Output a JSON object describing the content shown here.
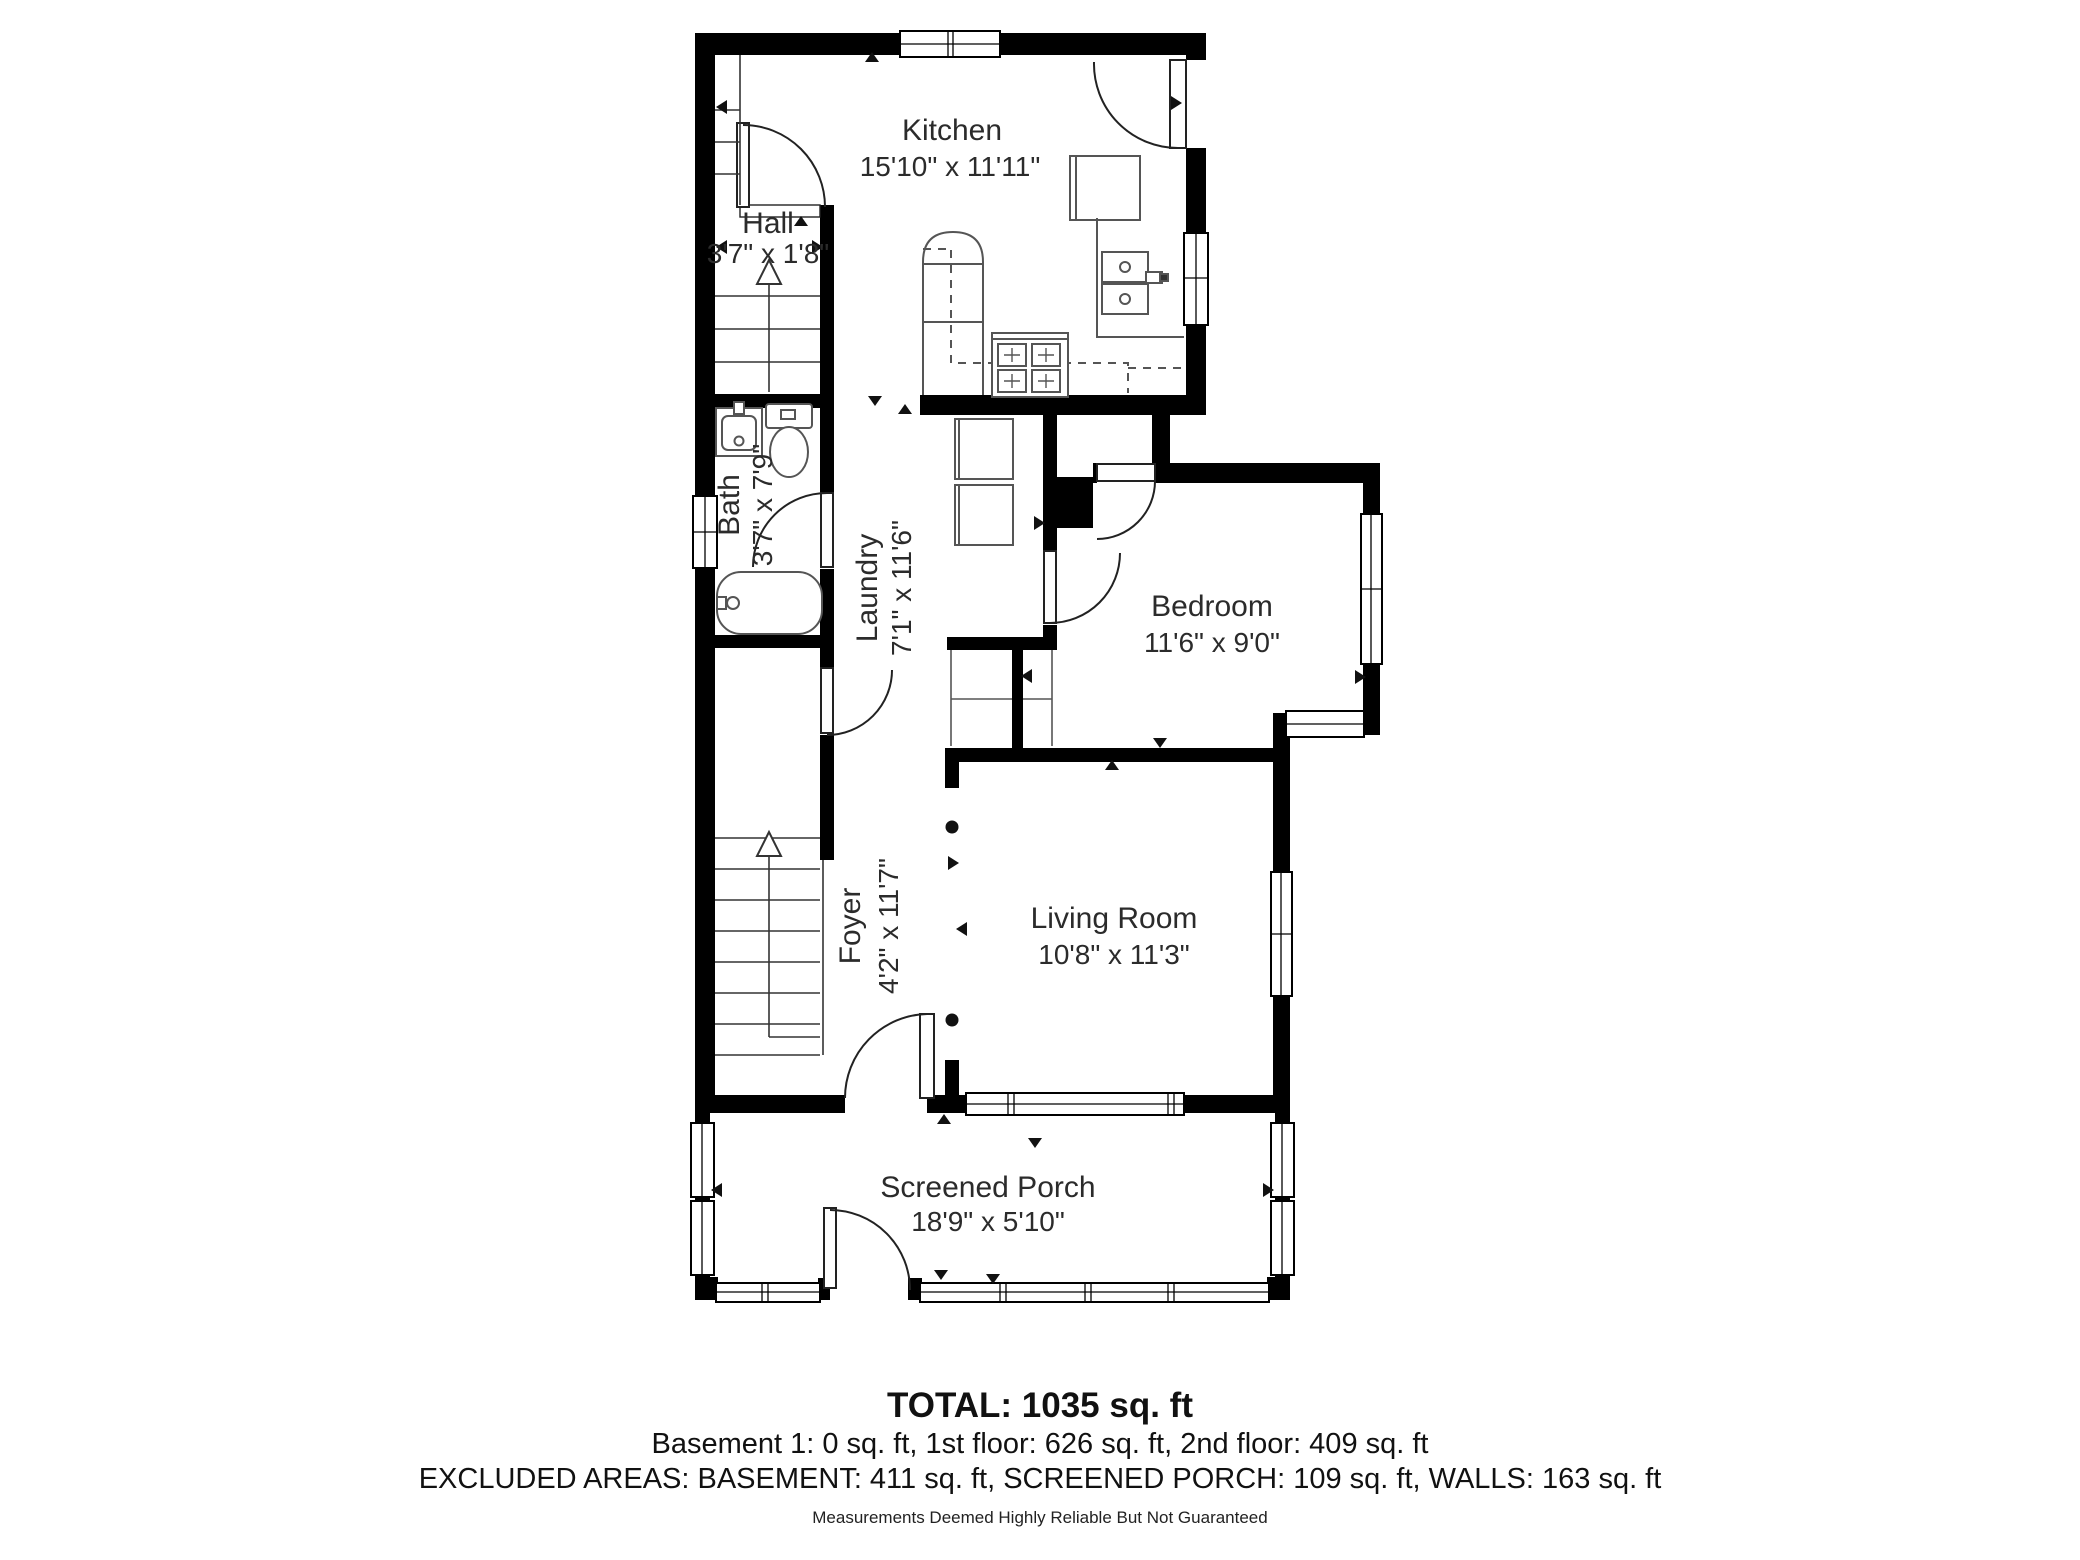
{
  "rooms": {
    "kitchen": {
      "name": "Kitchen",
      "dims": "15'10\" x 11'11\""
    },
    "hall": {
      "name": "Hall",
      "dims": "3'7\" x 1'8\""
    },
    "bath": {
      "name": "Bath",
      "dims": "3'7\" x 7'9\""
    },
    "laundry": {
      "name": "Laundry",
      "dims": "7'1\" x 11'6\""
    },
    "bedroom": {
      "name": "Bedroom",
      "dims": "11'6\" x 9'0\""
    },
    "foyer": {
      "name": "Foyer",
      "dims": "4'2\" x 11'7\""
    },
    "living_room": {
      "name": "Living Room",
      "dims": "10'8\" x 11'3\""
    },
    "screened_porch": {
      "name": "Screened Porch",
      "dims": "18'9\" x 5'10\""
    }
  },
  "summary": {
    "total": "TOTAL: 1035 sq. ft",
    "floors": "Basement 1: 0 sq. ft, 1st floor: 626 sq. ft, 2nd floor: 409 sq. ft",
    "excluded": "EXCLUDED AREAS: BASEMENT: 411 sq. ft, SCREENED PORCH: 109 sq. ft, WALLS: 163 sq. ft",
    "disclaimer": "Measurements Deemed Highly Reliable But Not Guaranteed"
  },
  "colors": {
    "wall": "#000000",
    "floor": "#ffffff",
    "fixture_stroke": "#555555"
  }
}
